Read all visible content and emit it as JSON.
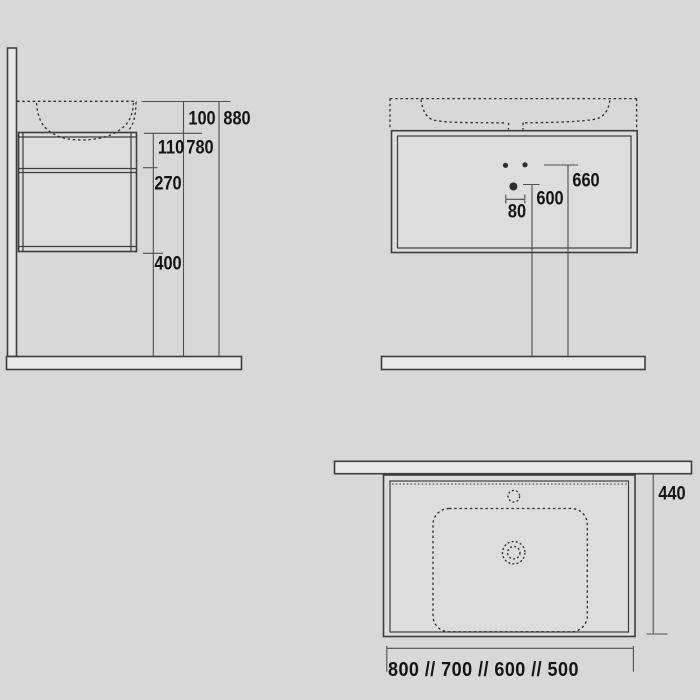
{
  "colors": {
    "background": "#d8d8d8",
    "outline": "#3d3d3d",
    "dashed": "#2e2e2e",
    "dim_line": "#4f4f4f",
    "text": "#141414",
    "surface_fill": "#e9e9e9",
    "panel_fill": "#dddddd"
  },
  "side_view": {
    "basin_height": "100",
    "total_height": "880",
    "drawer_height": "110",
    "worktop_height": "780",
    "lower_section_height": "270",
    "floor_clearance": "400"
  },
  "front_view": {
    "hole_height": "660",
    "drain_height": "600",
    "hole_spacing": "80"
  },
  "plan_view": {
    "depth": "440",
    "width_options": "800 // 700 // 600 // 500"
  }
}
